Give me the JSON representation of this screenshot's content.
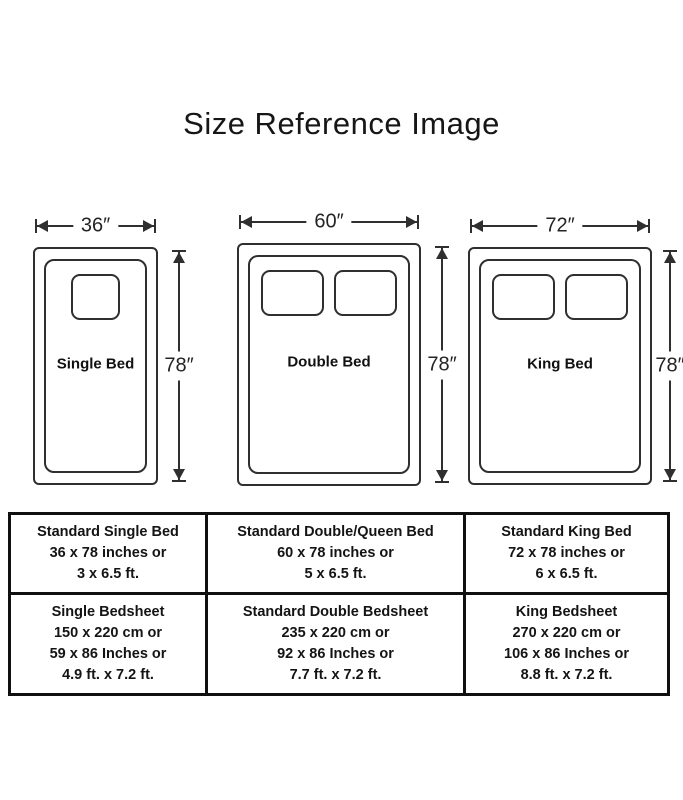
{
  "title": "Size Reference Image",
  "colors": {
    "background": "#ffffff",
    "diagram_line": "#2f2f2f",
    "table_border": "#101010",
    "text": "#1b1b1b"
  },
  "beds": [
    {
      "name": "Single Bed",
      "width_label": "36″",
      "height_label": "78″",
      "pillows": 1
    },
    {
      "name": "Double Bed",
      "width_label": "60″",
      "height_label": "78″",
      "pillows": 2
    },
    {
      "name": "King Bed",
      "width_label": "72″",
      "height_label": "78″",
      "pillows": 2
    }
  ],
  "table": {
    "rows": [
      {
        "cells": [
          {
            "lines": [
              "Standard Single Bed",
              "36 x 78 inches or",
              "3 x 6.5 ft."
            ]
          },
          {
            "lines": [
              "Standard Double/Queen Bed",
              "60 x 78 inches or",
              "5 x 6.5 ft."
            ]
          },
          {
            "lines": [
              "Standard King Bed",
              "72 x 78 inches or",
              "6 x 6.5 ft."
            ]
          }
        ]
      },
      {
        "cells": [
          {
            "lines": [
              "Single Bedsheet",
              "150 x 220 cm or",
              "59 x 86 Inches or",
              "4.9 ft. x 7.2 ft."
            ]
          },
          {
            "lines": [
              "Standard Double Bedsheet",
              "235 x 220 cm or",
              "92 x 86 Inches or",
              "7.7 ft. x 7.2 ft."
            ]
          },
          {
            "lines": [
              "King Bedsheet",
              "270 x 220 cm or",
              "106 x 86 Inches or",
              "8.8 ft. x 7.2 ft."
            ]
          }
        ]
      }
    ]
  }
}
